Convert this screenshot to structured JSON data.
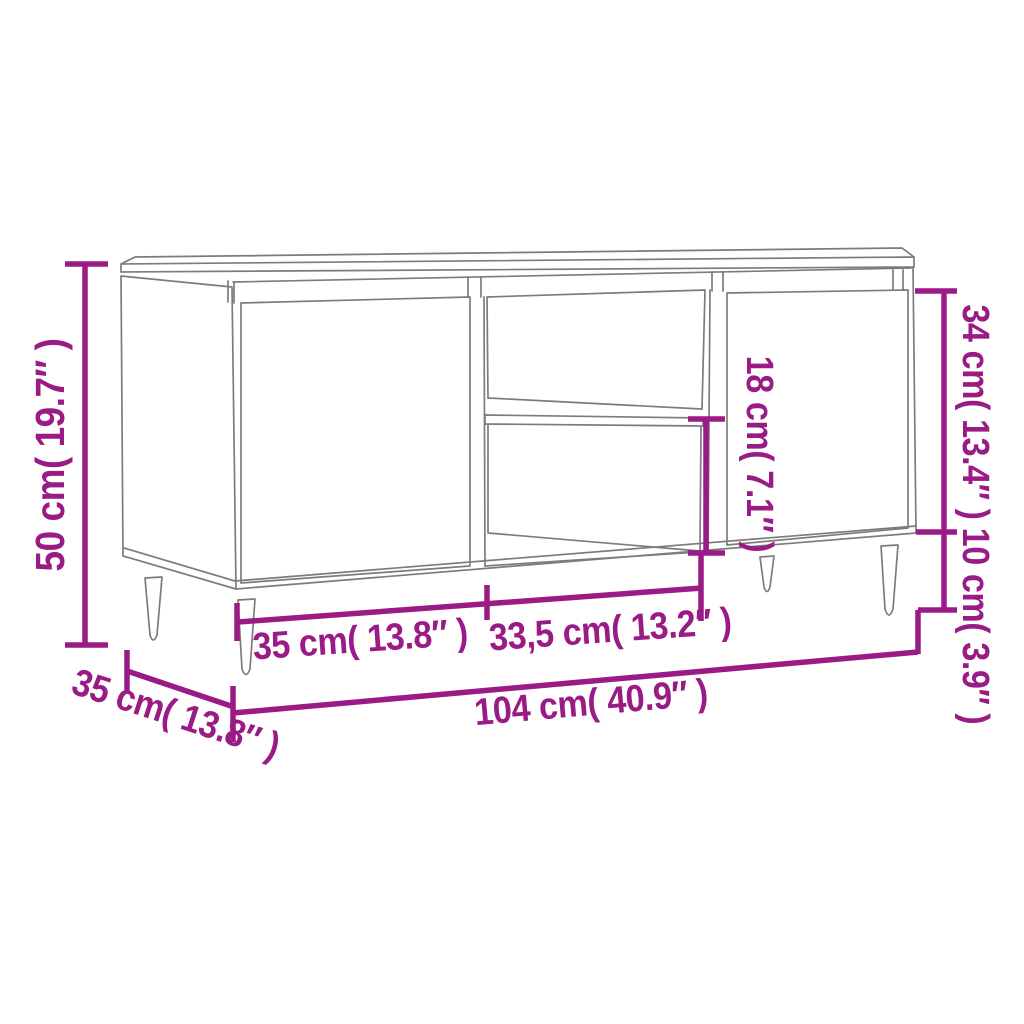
{
  "figure": {
    "title": "TV cabinet dimension diagram",
    "style": {
      "accent_color": "#9A1A86",
      "drawing_line_color": "#7C7C7C",
      "background_color": "#FFFFFF"
    }
  },
  "dimensions": {
    "overall_height": {
      "label": "50 cm( 19.7″ )"
    },
    "depth": {
      "label": "35 cm( 13.8″ )"
    },
    "left_door_width": {
      "label": "35 cm( 13.8″ )"
    },
    "middle_opening_width": {
      "label": "33,5 cm( 13.2″ )"
    },
    "overall_width": {
      "label": "104 cm( 40.9″ )"
    },
    "right_door_height": {
      "label": "34 cm( 13.4″ )"
    },
    "leg_height": {
      "label": "10 cm( 3.9″ )"
    },
    "opening_height": {
      "label": "18 cm( 7.1″ )"
    }
  }
}
